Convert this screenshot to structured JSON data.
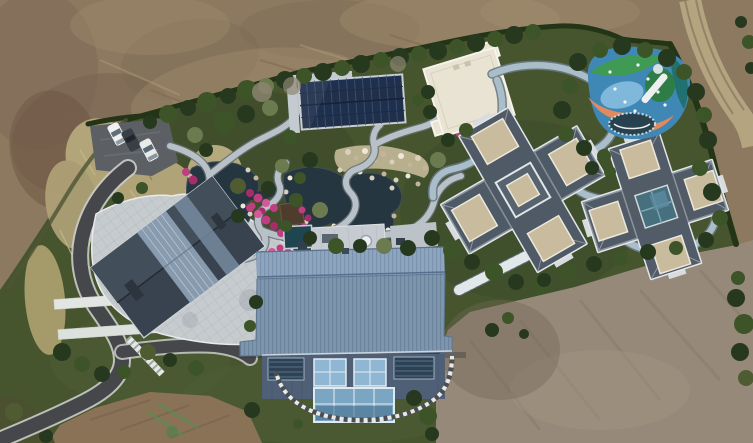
{
  "scene": {
    "type": "aerial-drone-photograph",
    "description": "Top-down drone view of a landscaped private estate surrounded by bare graded earth. A large blue metal-roof building sits at center-bottom, a dark gabled house with stone patio at left, two cross-shaped slate-roof mansions at right, a white flat-roof building and a dark solar-panel canopy at top-center, a koi pond garden with winding pale paths and magenta flower beds at center-left, a multicolor playground at top-right, a parking pad with three cars at top-left, a curving asphalt driveway at lower-left, and a dirt track road at top-right. No text or UI elements are visible.",
    "no_text_present": true
  },
  "palette": {
    "dirt_base": "#8c7960",
    "dirt_dark": "#6f5d4b",
    "dirt_light": "#a7936f",
    "dirt_gray": "#97897a",
    "dirt_red": "#8a7257",
    "dirt_road": "#b9a884",
    "lawn": "#46552e",
    "lawn_dark": "#39482a",
    "hedge": "#233417",
    "scrub_olive": "#4b5130",
    "tall_grass": "#b9ab7e",
    "water": "#263641",
    "path_light": "#b7c1c7",
    "path_casing": "#677077",
    "track": "#a9bec9",
    "road_asphalt": "#45474b",
    "road_edge": "#c9ccc9",
    "blue_roof": "#7e95ae",
    "blue_facade": "#4f6076",
    "glass": "#8fb6d2",
    "slate_roof": "#4f5a66",
    "parapet": "#e3e7ea",
    "tan_panel": "#c9bc9e",
    "house_roof": "#39434f",
    "patio_stone": "#c6cbce",
    "cream_roof": "#e9e3d3",
    "solar_dark": "#20304a",
    "pink_flower": "#bf3d80",
    "play_blue": "#3f87b5",
    "play_green": "#3f9b53",
    "play_teal": "#20716f",
    "play_orange": "#e08a5e",
    "car_white": "#f0f0f0",
    "car_dark": "#3a3f46"
  },
  "objects": {
    "bare_earth": {
      "note": "graded brown soil surrounds the estate on top, lower-left and lower-right"
    },
    "dirt_track_road": {
      "note": "tire-tracked dirt road curving along the top-right corner"
    },
    "estate_grounds": {
      "note": "hedge-bounded landscaped compound with lawns, shrubs and specimen trees"
    },
    "parking_area": {
      "car_count": 3,
      "car_colors": [
        "white",
        "dark gray",
        "white"
      ],
      "note": "asphalt pad beside tall dry grass"
    },
    "driveway": {
      "note": "dark asphalt S-curve with pale edges running to the lower-left corner"
    },
    "left_house": {
      "note": "dark gabled roof with central glass skylight band, set in a pale stone-tile patio"
    },
    "pond_garden": {
      "note": "two dark ponds linked by streams, white boulder edging, winding pale paths, magenta azalea beds, small timber deck"
    },
    "solar_canopy": {
      "note": "dark navy photovoltaic rectangle with pale surround, above the pond"
    },
    "white_flat_roof_building": {
      "note": "cream flat roof, slightly rotated, with small dark plunge pool at its corner"
    },
    "blue_metal_roof_building": {
      "note": "large ribbed blue-gray standing-seam roof, louvered and glazed facade, projecting glass bay, checkered stepping-stone arc below, rooftop pool and spa terrace above"
    },
    "middle_mansion": {
      "note": "cross-shaped slate roof with white parapets and tan flat decks"
    },
    "right_mansion": {
      "note": "cross-shaped slate roof with white parapets, tan decks and central glass atrium"
    },
    "looping_track_path": {
      "note": "pale blue-gray path looping around playground and both mansions"
    },
    "garden_steps": {
      "note": "wide stone stair ramp descending from the mansions to the lawn"
    },
    "playground": {
      "surface_colors": [
        "blue",
        "green",
        "teal",
        "orange",
        "light blue"
      ],
      "features": [
        "white slide",
        "trampoline",
        "scattered balls"
      ]
    },
    "tall_dry_grass": {
      "note": "pale ornamental grass drifts around parking and driveway"
    },
    "paint_marks": {
      "note": "green marking-paint streaks on the lower-left dirt"
    }
  }
}
